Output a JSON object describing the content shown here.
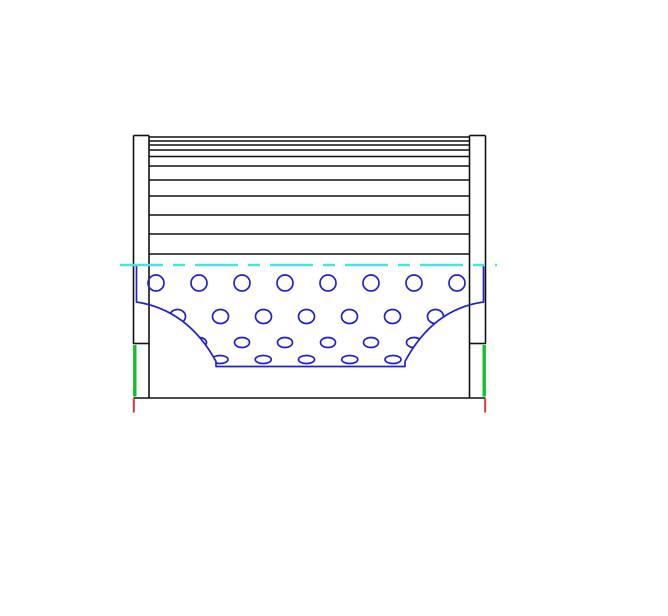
{
  "drawing": {
    "canvas": {
      "width": 668,
      "height": 616,
      "background": "#ffffff"
    },
    "colors": {
      "outline": "#111111",
      "core": "#2222cc",
      "centerline": "#4fe0e6",
      "seal": "#12bf2c",
      "datum": "#d93535"
    },
    "stroke_widths": {
      "outline": 1.6,
      "core": 1.7,
      "centerline": 2.6,
      "seal": 3.4,
      "datum": 2.0
    },
    "element": {
      "left_cap": {
        "outer_x": 133.5,
        "inner_x": 149.0,
        "top_y": 135.5
      },
      "right_cap": {
        "outer_x": 485.5,
        "inner_x": 469.5,
        "top_y": 135.5
      },
      "cap_black_outer_end_y": 344,
      "cap_mid_tick_y": 343.5,
      "bottom_y": 398,
      "pleats": {
        "left_x": 149,
        "right_x": 469.5,
        "line_ys": [
          137,
          141,
          145,
          150,
          156.5,
          166,
          180,
          196,
          215,
          234,
          254
        ]
      },
      "seal_bars": {
        "y1": 345,
        "y2": 396.5,
        "left_x": 134.8,
        "right_x": 484.2
      },
      "datum_ticks": {
        "y1": 398.8,
        "y2": 412.5,
        "left_x": 133.8,
        "right_x": 485.2
      }
    },
    "centerline": {
      "y": 265,
      "x1": 120,
      "x2": 497,
      "dash": "43 10 12 10"
    },
    "core_tube": {
      "outline_path": "M 136.5 265 L 136.5 302 Q 188 310 216 361.5 L 216 366.5 L 405 366.5 L 405 361.5 Q 433 309 483.5 302 L 483.5 265",
      "clip_d": "M 136.5 265 L 136.5 302 Q 188 310 216 361.5 L 216 366.5 L 405 366.5 L 405 361.5 Q 433 309 483.5 302 L 483.5 265 Z",
      "hole_rows": [
        {
          "y": 283.0,
          "rx": 8.0,
          "ry": 8.0,
          "xs": [
            156,
            199,
            242,
            285,
            328,
            371,
            414,
            457
          ]
        },
        {
          "y": 316.5,
          "rx": 8.0,
          "ry": 7.0,
          "xs": [
            177.5,
            220.5,
            263.5,
            306.5,
            349.5,
            392.5,
            435.5
          ]
        },
        {
          "y": 342.5,
          "rx": 7.5,
          "ry": 5.0,
          "xs": [
            199,
            242,
            285,
            328,
            371,
            414
          ]
        },
        {
          "y": 359.5,
          "rx": 8.0,
          "ry": 4.0,
          "xs": [
            220,
            263.25,
            306.5,
            349.75,
            393
          ]
        }
      ]
    }
  }
}
